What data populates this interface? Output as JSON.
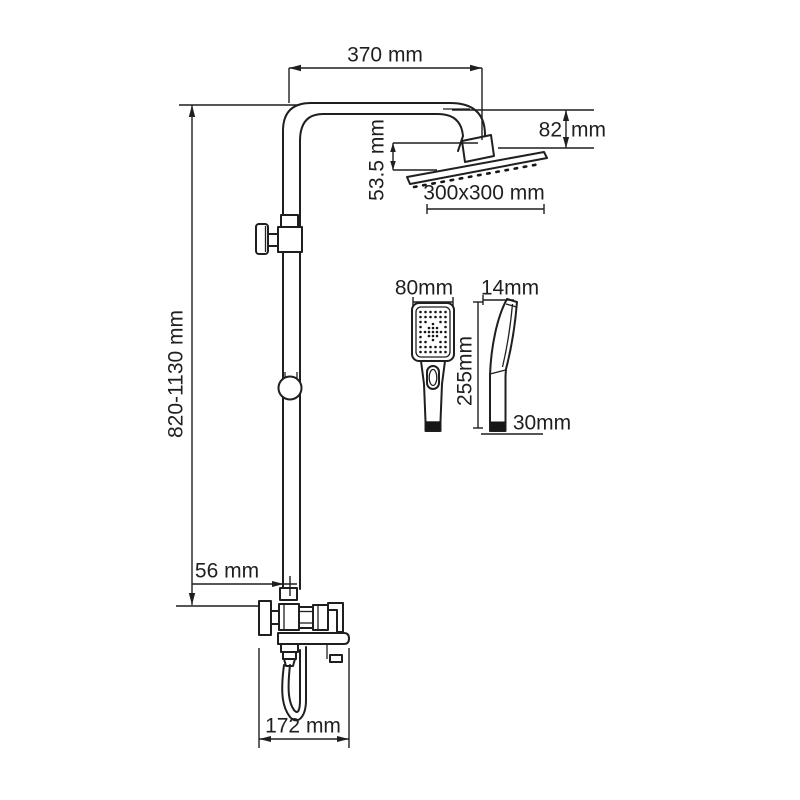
{
  "colors": {
    "line": "#1f1f1f",
    "background": "#ffffff"
  },
  "labels": {
    "arm_reach": "370 mm",
    "head_drop_value": "82",
    "head_drop_unit": "mm",
    "head_offset": "53.5 mm",
    "head_size": "300x300 mm",
    "column_height": "820-1130 mm",
    "wall_to_pipe": "56 mm",
    "spout_depth": "172 mm",
    "handshower_width": "80mm",
    "handshower_thickness": "14mm",
    "handshower_length": "255mm",
    "handshower_bottom": "30mm"
  }
}
